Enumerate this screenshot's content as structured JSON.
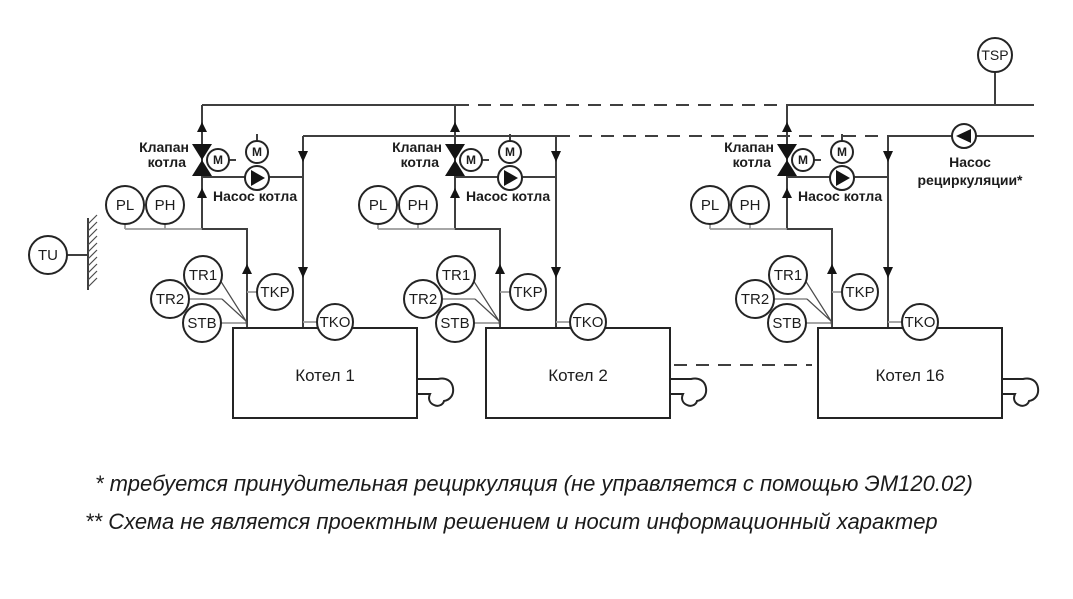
{
  "diagram": {
    "outdoor_sensor": {
      "label": "TU"
    },
    "supply_sensor": {
      "label": "TSP"
    },
    "recirculation_pump": {
      "label_line1": "Насос",
      "label_line2": "рециркуляции*"
    },
    "boiler_groups": [
      {
        "boiler_name": "Котел 1",
        "valve_label_line1": "Клапан",
        "valve_label_line2": "котла",
        "pump_label": "Насос котла",
        "motor_label": "M",
        "sensors": {
          "pl": "PL",
          "ph": "PH",
          "tr1": "TR1",
          "tr2": "TR2",
          "stb": "STB",
          "tkp": "TKP",
          "tko": "TKO"
        }
      },
      {
        "boiler_name": "Котел 2",
        "valve_label_line1": "Клапан",
        "valve_label_line2": "котла",
        "pump_label": "Насос котла",
        "motor_label": "M",
        "sensors": {
          "pl": "PL",
          "ph": "PH",
          "tr1": "TR1",
          "tr2": "TR2",
          "stb": "STB",
          "tkp": "TKP",
          "tko": "TKO"
        }
      },
      {
        "boiler_name": "Котел 16",
        "valve_label_line1": "Клапан",
        "valve_label_line2": "котла",
        "pump_label": "Насос котла",
        "motor_label": "M",
        "sensors": {
          "pl": "PL",
          "ph": "PH",
          "tr1": "TR1",
          "tr2": "TR2",
          "stb": "STB",
          "tkp": "TKP",
          "tko": "TKO"
        }
      }
    ],
    "footnotes": [
      "* требуется принудительная рециркуляция (не управляется с помощью ЭМ120.02)",
      "** Схема не является проектным решением и носит информационный характер"
    ],
    "colors": {
      "background": "#ffffff",
      "line": "#3f3f3f",
      "text": "#1c1c1c"
    }
  }
}
